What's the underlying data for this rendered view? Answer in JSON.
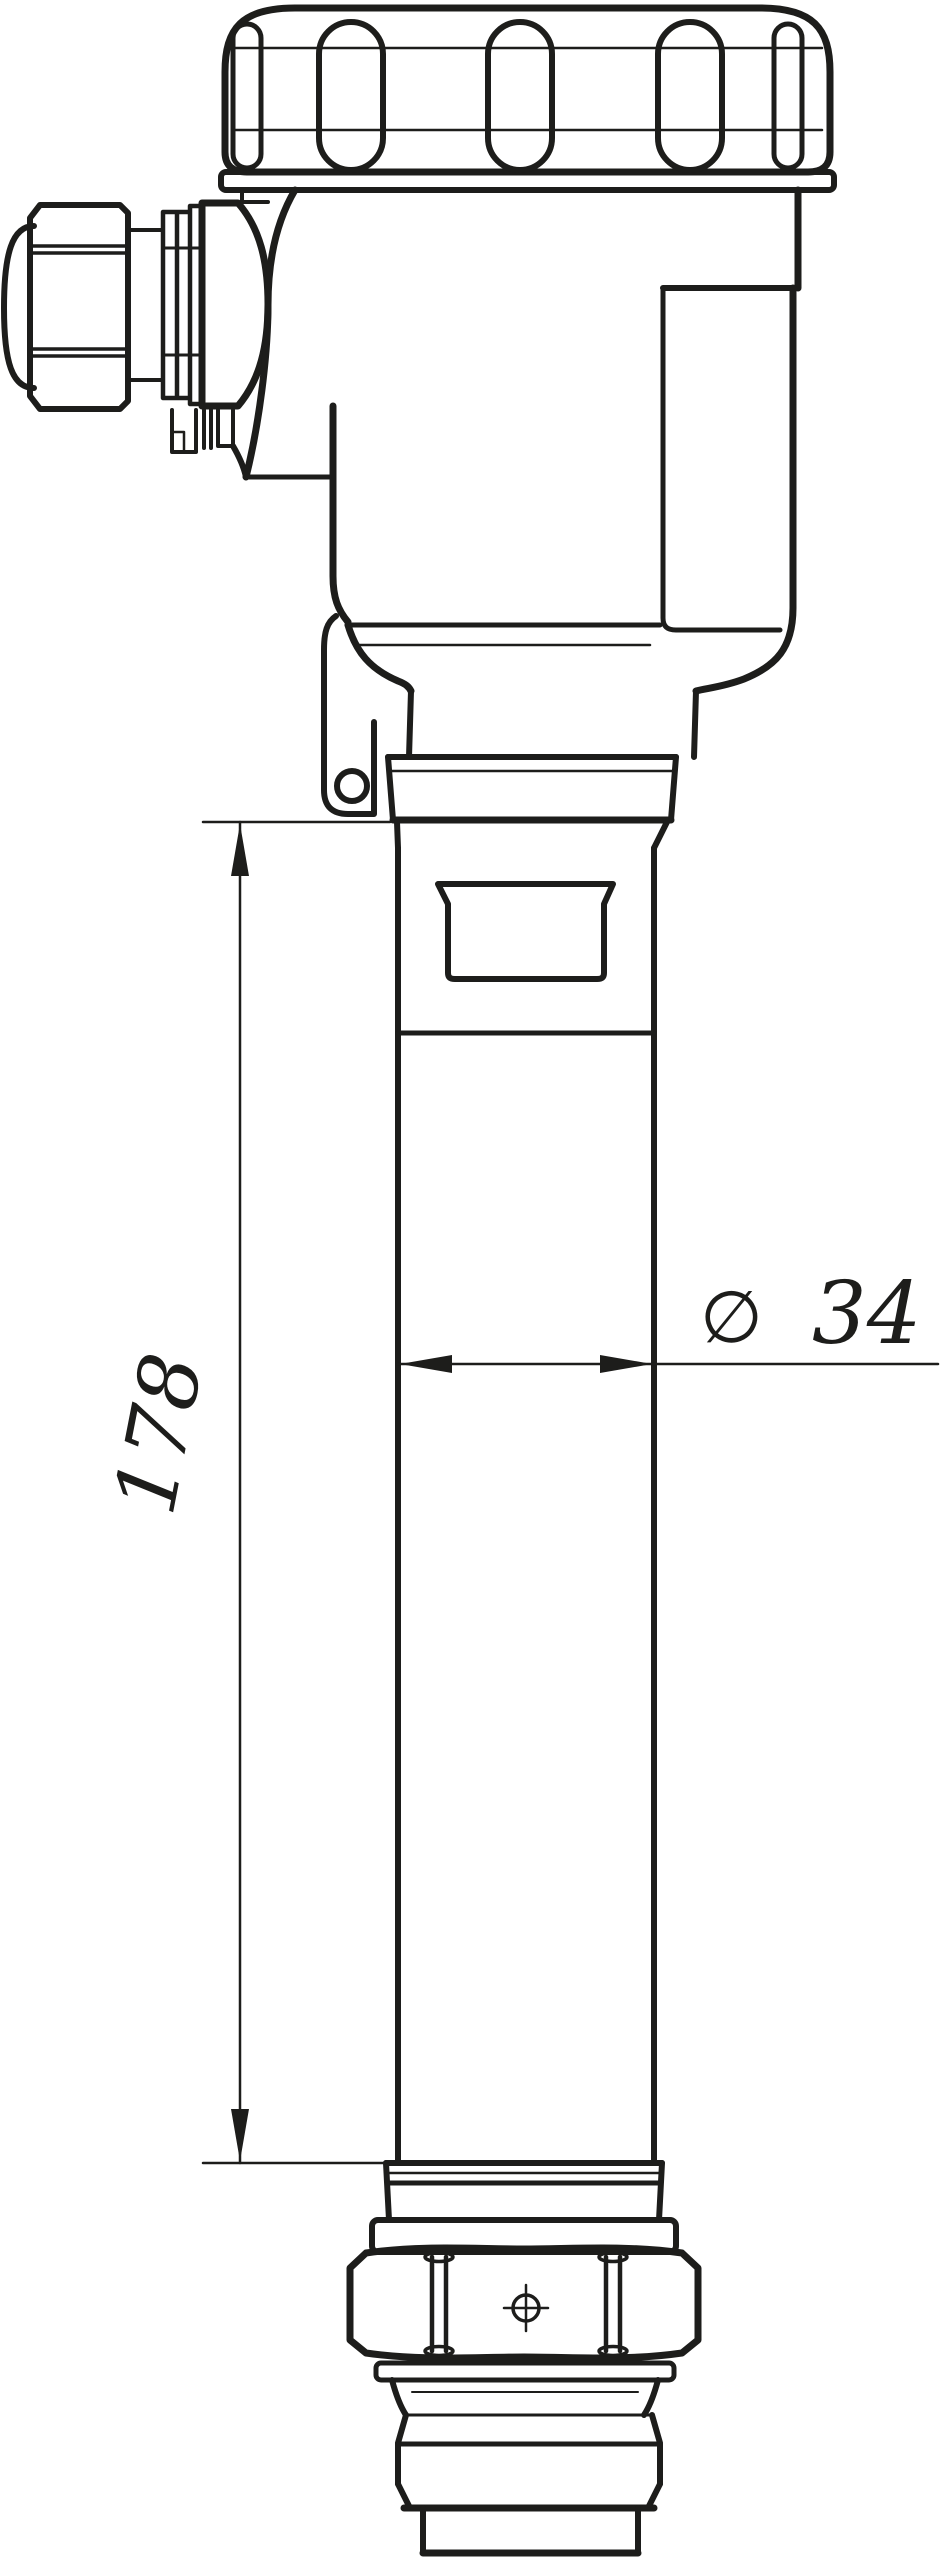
{
  "drawing": {
    "kind": "technical-dimension-drawing",
    "subject": "rod-level-sensor-with-screw-cover-housing",
    "background_color": "#ffffff",
    "line_color": "#1d1d1b"
  },
  "dimensions": {
    "length": {
      "value": "178"
    },
    "diameter": {
      "symbol": "∅",
      "value": "34"
    }
  }
}
